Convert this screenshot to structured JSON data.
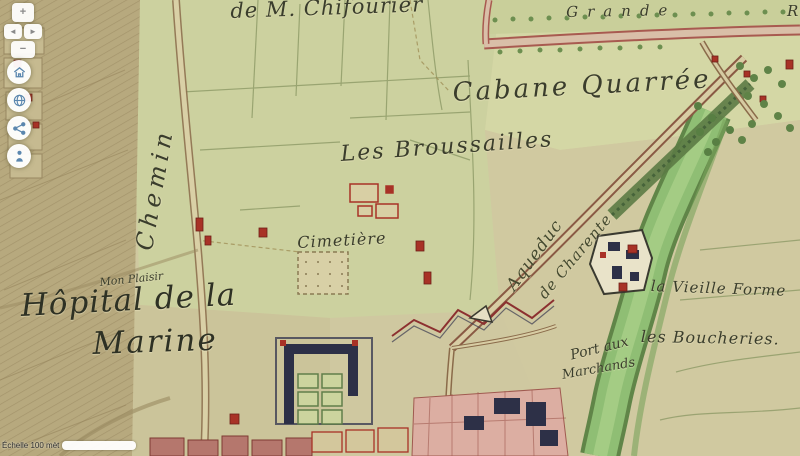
{
  "viewer": {
    "controls": {
      "zoom_in": "+",
      "zoom_out": "−",
      "pan_left": "◄",
      "pan_right": "►",
      "icon_color": "#5b87ae",
      "round_buttons": [
        {
          "id": "home",
          "icon": "home-icon"
        },
        {
          "id": "globe",
          "icon": "globe-icon"
        },
        {
          "id": "share",
          "icon": "share-icon"
        },
        {
          "id": "locate",
          "icon": "person-locate-icon"
        }
      ]
    },
    "scale_bar": {
      "label": "Échelle 100 mèt"
    }
  },
  "map": {
    "palette": {
      "parchment": "#cfc8a0",
      "field_green": "#ccd19f",
      "river_green": "#8fbe74",
      "building_red": "#a83226",
      "building_dark": "#2d3047",
      "road_border": "#8a6b4a",
      "pink_road": "#d9bfa8",
      "icon_blue": "#5b87ae"
    },
    "labels": [
      {
        "id": "estate-name",
        "text": "de M. Chifourier",
        "x": 230,
        "y": 1,
        "rotate": -2,
        "size": 21,
        "spacing": 1
      },
      {
        "id": "grande-road",
        "text": "Grande",
        "x": 566,
        "y": 5,
        "rotate": -1,
        "size": 15,
        "spacing": 9
      },
      {
        "id": "grande-road-partial",
        "text": "R",
        "x": 787,
        "y": 4,
        "rotate": 0,
        "size": 15,
        "spacing": 0
      },
      {
        "id": "cabane-quarree",
        "text": "Cabane Quarrée",
        "x": 452,
        "y": 80,
        "rotate": -3,
        "size": 26,
        "spacing": 3
      },
      {
        "id": "les-broussailles",
        "text": "Les Broussailles",
        "x": 340,
        "y": 144,
        "rotate": -4,
        "size": 22,
        "spacing": 2
      },
      {
        "id": "chemin",
        "text": "Chemin",
        "x": 132,
        "y": 248,
        "rotate": -80,
        "size": 24,
        "spacing": 5
      },
      {
        "id": "cimetiere",
        "text": "Cimetière",
        "x": 297,
        "y": 235,
        "rotate": -3,
        "size": 16,
        "spacing": 1
      },
      {
        "id": "mon-plaisir",
        "text": "Mon Plaisir",
        "x": 99,
        "y": 277,
        "rotate": -6,
        "size": 11,
        "spacing": 0
      },
      {
        "id": "hopital-line-1",
        "text": "Hôpital de la",
        "x": 20,
        "y": 291,
        "rotate": -3,
        "size": 31,
        "spacing": 1,
        "color": "#2e3124"
      },
      {
        "id": "hopital-line-2",
        "text": "Marine",
        "x": 92,
        "y": 329,
        "rotate": -2,
        "size": 31,
        "spacing": 2,
        "color": "#2e3124"
      },
      {
        "id": "aqueduc",
        "text": "Aqueduc",
        "x": 504,
        "y": 284,
        "rotate": -54,
        "size": 17,
        "spacing": 1,
        "color": "#44492f"
      },
      {
        "id": "de-charente",
        "text": "de Charente",
        "x": 536,
        "y": 292,
        "rotate": -50,
        "size": 15,
        "spacing": 1,
        "color": "#44492f"
      },
      {
        "id": "la-vieille-forme",
        "text": "la Vieille Forme",
        "x": 651,
        "y": 279,
        "rotate": 2,
        "size": 15,
        "spacing": 1
      },
      {
        "id": "les-boucheries",
        "text": "les Boucheries.",
        "x": 641,
        "y": 329,
        "rotate": 1,
        "size": 16,
        "spacing": 1
      },
      {
        "id": "port-aux",
        "text": "Port aux",
        "x": 569,
        "y": 349,
        "rotate": -14,
        "size": 14,
        "spacing": 0
      },
      {
        "id": "marchands",
        "text": "Marchands",
        "x": 561,
        "y": 369,
        "rotate": -10,
        "size": 13,
        "spacing": 0
      }
    ]
  }
}
